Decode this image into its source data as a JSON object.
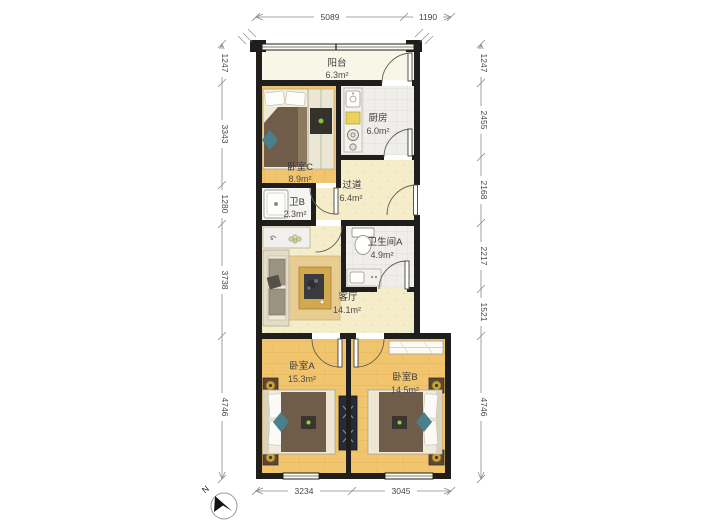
{
  "plan_title": "residential-floor-plan",
  "rooms": {
    "balcony": {
      "name": "阳台",
      "area": "6.3m²"
    },
    "kitchen": {
      "name": "厨房",
      "area": "6.0m²"
    },
    "bedroom_c": {
      "name": "卧室C",
      "area": "8.9m²"
    },
    "hallway": {
      "name": "过道",
      "area": "6.4m²"
    },
    "bath_b": {
      "name": "卫B",
      "area": "2.3m²"
    },
    "bath_a": {
      "name": "卫生间A",
      "area": "4.9m²"
    },
    "living": {
      "name": "客厅",
      "area": "14.1m²"
    },
    "bedroom_a": {
      "name": "卧室A",
      "area": "15.3m²"
    },
    "bedroom_b": {
      "name": "卧室B",
      "area": "14.5m²"
    }
  },
  "dimensions": {
    "top": [
      "5089",
      "1190"
    ],
    "bottom": [
      "3234",
      "3045"
    ],
    "left": [
      "1247",
      "3343",
      "1280",
      "3738",
      "4746"
    ],
    "right": [
      "1247",
      "2455",
      "2168",
      "2217",
      "1521",
      "4746"
    ]
  },
  "compass": {
    "north_label": "N"
  },
  "colors": {
    "wall": "#201e1c",
    "wood_floor": "#f0c471",
    "cream_floor": "#f5ecca",
    "tile_floor": "#efeeea",
    "balcony_floor": "#f8f6e6",
    "duvet_brown": "#6f5c49",
    "lamp_gold": "#c9a23b",
    "dim_line": "#8a8a8a"
  }
}
